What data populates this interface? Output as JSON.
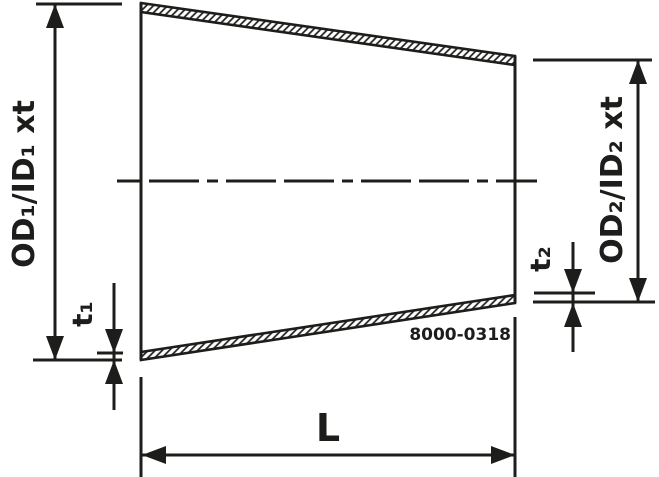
{
  "drawing": {
    "part_number": "8000-0318",
    "labels": {
      "left_diameter": "OD₁/ID₁ xt",
      "right_diameter": "OD₂/ID₂ xt",
      "wall_thickness_left": "t₁",
      "wall_thickness_right": "t₂",
      "length": "L"
    },
    "colors": {
      "line": "#1d1d1b",
      "background": "#ffffff"
    }
  }
}
